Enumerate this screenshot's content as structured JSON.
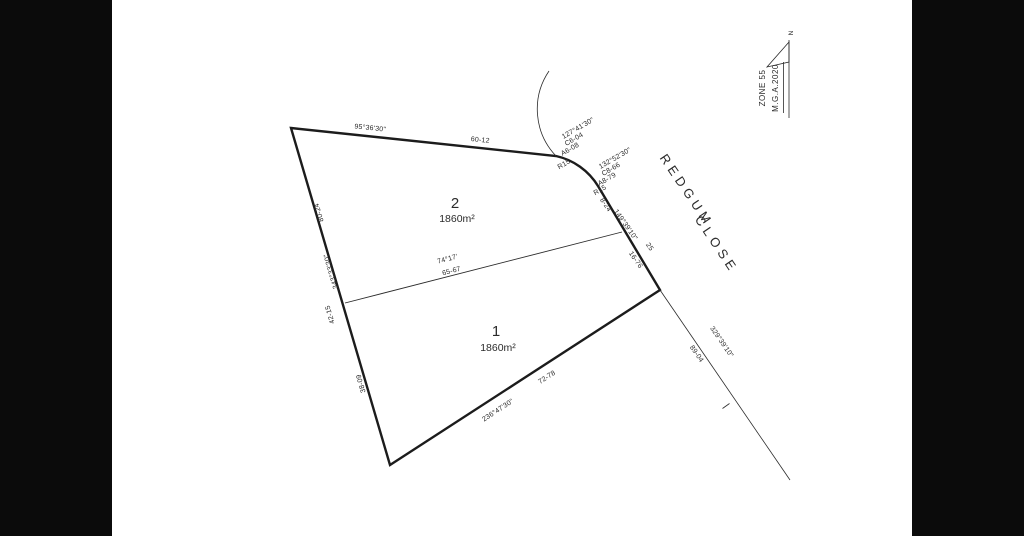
{
  "colors": {
    "background": "#ffffff",
    "side_bar": "#0b0b0b",
    "line": "#1c1c1c",
    "text": "#2b2b2b"
  },
  "road": {
    "name_word1": "REDGUM",
    "name_word2": "CLOSE"
  },
  "north_arrow": {
    "north": "N",
    "zone": "ZONE 55",
    "datum": "M.G.A.2020"
  },
  "lots": {
    "lot2": {
      "number": "2",
      "area": "1860m²"
    },
    "lot1": {
      "number": "1",
      "area": "1860m²"
    }
  },
  "boundaries": {
    "top": {
      "bearing": "95°36'30\"",
      "distance": "60-12"
    },
    "left": {
      "bearing": "343°33'30\"",
      "total": "80-24",
      "lot2_segment": "42-15",
      "lot1_segment": "38-09"
    },
    "bottom": {
      "bearing": "236°47'30\"",
      "distance": "72-78"
    },
    "right": {
      "bearing": "149°39'10\"",
      "total": "25",
      "upper_segment": "8-24",
      "lower_segment": "16-76"
    },
    "internal": {
      "bearing": "74°17'",
      "distance": "65-67"
    },
    "road_frontage": {
      "bearing": "329°39'10\"",
      "distance": "89-04"
    },
    "curve1": {
      "bearing": "127°41'30\"",
      "chord": "C6-04",
      "arc": "A6-08",
      "radius": "R15"
    },
    "curve2": {
      "bearing": "132°52'30\"",
      "chord": "C8-66",
      "arc": "A8-79",
      "radius": "R15"
    }
  }
}
